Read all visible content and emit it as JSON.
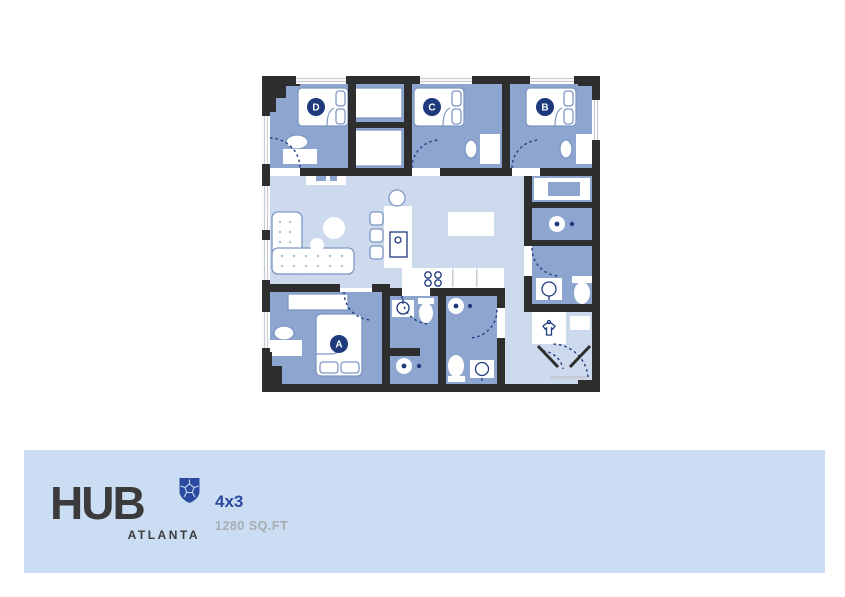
{
  "palette": {
    "wall": "#2e2e2e",
    "floorDark": "#8da5cf",
    "floorLight": "#cdd9ec",
    "band": "#cbddf2",
    "navy": "#1e3a7d",
    "brandBlue": "#2b4aa0",
    "furnStroke": "#7d97c4",
    "windowGray": "#c6ccd5",
    "logoDark": "#3b3b3b",
    "sqftGray": "#a7acb2"
  },
  "floorplan": {
    "rooms": [
      {
        "id": "bedroom-d",
        "label": "D"
      },
      {
        "id": "bedroom-c",
        "label": "C"
      },
      {
        "id": "bedroom-b",
        "label": "B"
      },
      {
        "id": "bedroom-a",
        "label": "A"
      }
    ]
  },
  "footer": {
    "brand": "HUB",
    "location": "ATLANTA",
    "unit_type": "4x3",
    "area": "1280 SQ.FT"
  }
}
